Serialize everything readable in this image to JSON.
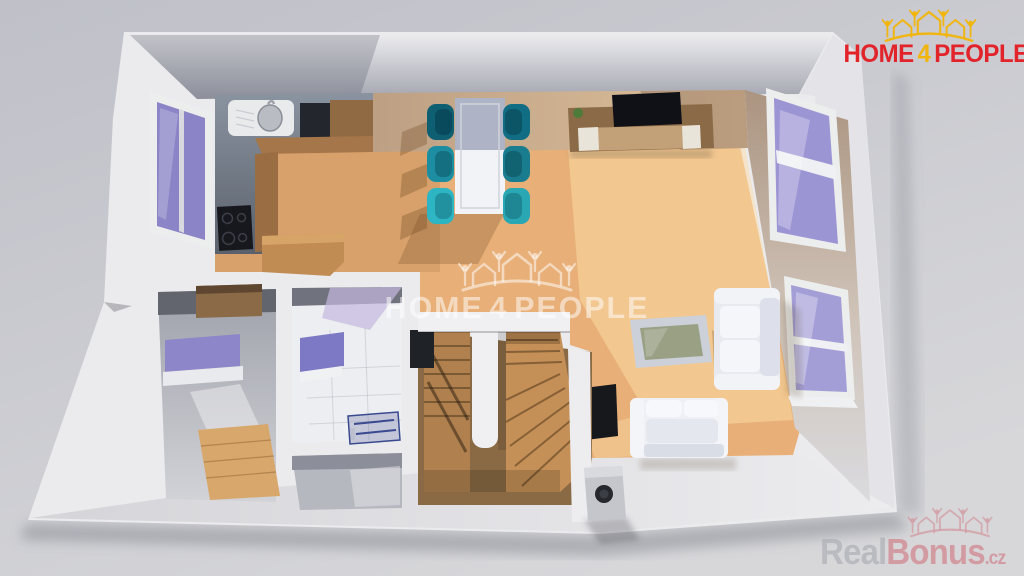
{
  "branding": {
    "logo": {
      "word1": "HOME",
      "word2": "4",
      "word3": "PEOPLE",
      "icon": "houses-people-crown-icon"
    },
    "center_watermark": {
      "word1": "HOME",
      "word2": "4",
      "word3": "PEOPLE",
      "icon": "houses-people-crown-icon"
    },
    "corner_watermark": {
      "part1": "Real",
      "part2": "Bonus",
      "part3": ".cz",
      "icon": "houses-crown-icon"
    }
  },
  "theme": {
    "logo_red": "#e2232a",
    "logo_gold": "#f2b50d",
    "watermark_white": "rgba(255,255,255,0.52)",
    "realbonus_gray": "rgba(173,174,180,0.85)",
    "realbonus_pink": "rgba(207,122,131,0.8)",
    "wall_white": "#ebebee",
    "wood_floor": "#e8b078",
    "wood_stairs": "#b0814e",
    "window_glass": "#9c95d4",
    "chair_teal_dark": "#0f5f73",
    "chair_teal_mid": "#1d8ea2",
    "chair_teal_bright": "#2db5c3"
  },
  "scene": {
    "type": "3d-floorplan-render",
    "view": "top-down cutaway of a single floor, white walls, wooden floor",
    "rooms": [
      "kitchen",
      "dining-area",
      "living-area",
      "entry-hall",
      "bathroom",
      "wc",
      "staircase"
    ],
    "furniture": [
      "kitchen-counter-with-sink",
      "cooktop",
      "kitchen-island",
      "dining-table",
      "six-teal-chairs",
      "tv-sideboard",
      "flat-tv",
      "plant",
      "coffee-table",
      "white-sofa-vertical",
      "white-sofa-horizontal",
      "wall-tv",
      "purple-wall-shelf",
      "wooden-dresser",
      "parquet-patch",
      "bathroom-mirror",
      "shower",
      "pedestal-sink",
      "u-shaped-wooden-stairs",
      "chimney-flue",
      "left-window",
      "upper-right-window",
      "lower-right-window"
    ]
  }
}
